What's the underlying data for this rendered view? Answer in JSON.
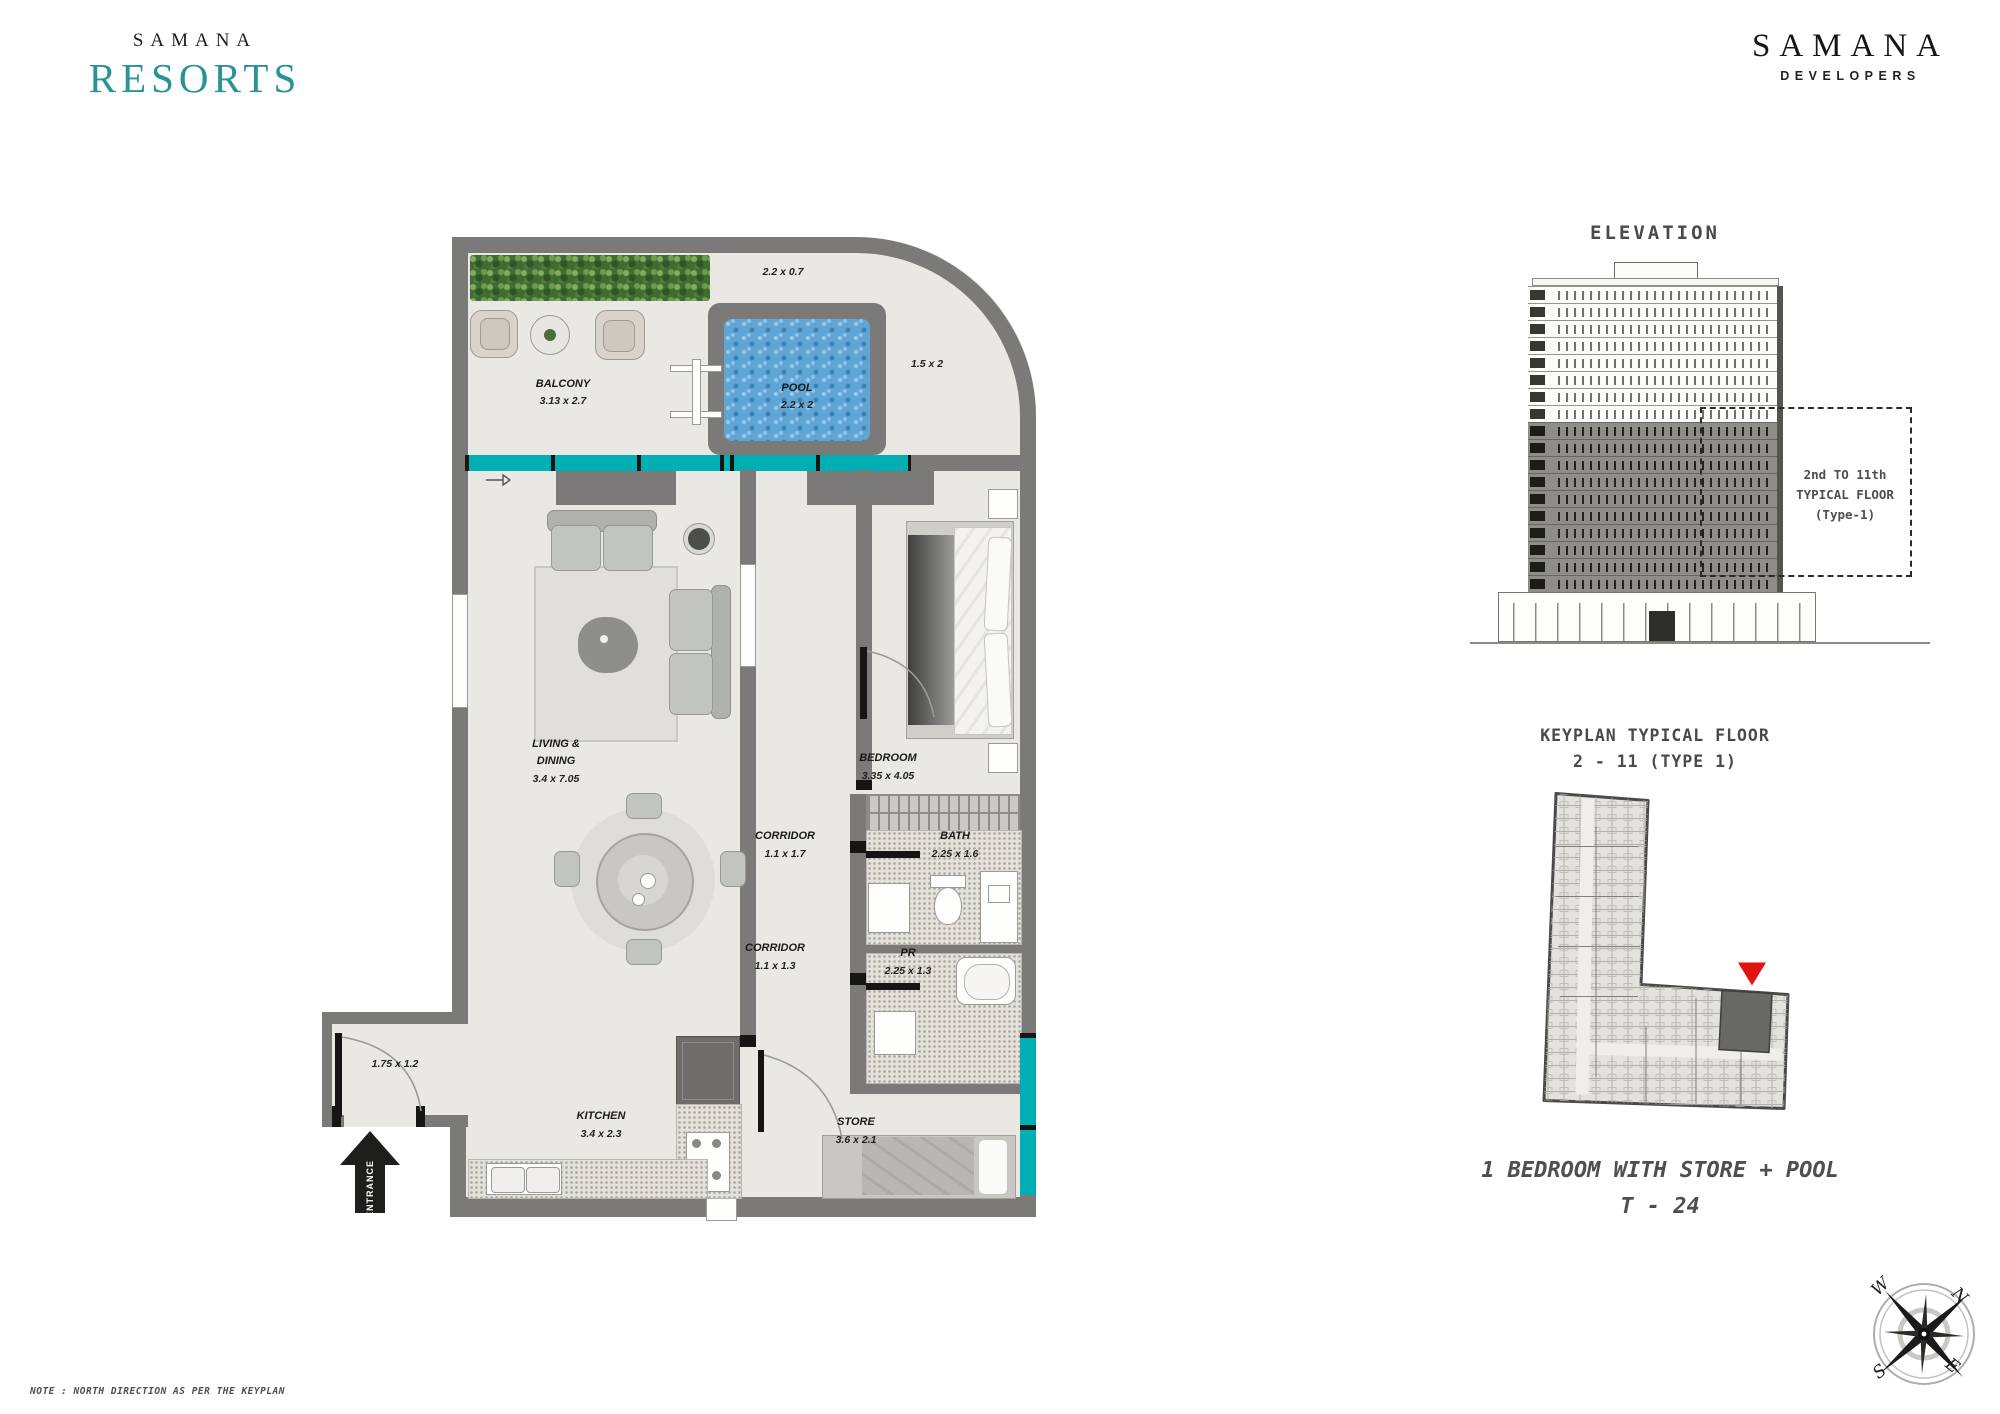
{
  "brand_left": {
    "name": "SAMANA",
    "sub": "RESORTS"
  },
  "brand_right": {
    "name": "SAMANA",
    "sub": "DEVELOPERS"
  },
  "plan": {
    "balcony_name": "BALCONY",
    "balcony_dims": "3.13 x 2.7",
    "pool_name": "POOL",
    "pool_dims": "2.2 x 2",
    "pool_deck_dims": "2.2 x 0.7",
    "side_deck_dims": "1.5 x 2",
    "living_name1": "LIVING &",
    "living_name2": "DINING",
    "living_dims": "3.4 x 7.05",
    "bedroom_name": "BEDROOM",
    "bedroom_dims": "3.35 x 4.05",
    "corridor1_name": "CORRIDOR",
    "corridor1_dims": "1.1 x 1.7",
    "bath_name": "BATH",
    "bath_dims": "2.25 x 1.6",
    "corridor2_name": "CORRIDOR",
    "corridor2_dims": "1.1 x 1.3",
    "pr_name": "PR",
    "pr_dims": "2.25 x 1.3",
    "entry_dims": "1.75 x 1.2",
    "kitchen_name": "KITCHEN",
    "kitchen_dims": "3.4 x 2.3",
    "store_name": "STORE",
    "store_dims": "3.6 x 2.1",
    "entrance_label": "ENTRANCE"
  },
  "elevation": {
    "title": "ELEVATION",
    "note1": "2nd TO 11th",
    "note2": "TYPICAL FLOOR",
    "note3": "(Type-1)"
  },
  "keyplan": {
    "title1": "KEYPLAN TYPICAL FLOOR",
    "title2": "2 - 11 (TYPE 1)"
  },
  "unit": {
    "name": "1 BEDROOM WITH STORE + POOL",
    "code": "T - 24"
  },
  "compass": {
    "n": "N",
    "e": "E",
    "s": "S",
    "w": "W"
  },
  "footnote": "NOTE : NORTH DIRECTION AS PER THE KEYPLAN",
  "colors": {
    "teal_window": "#00AFB4",
    "brand_teal": "#2B9398",
    "pool_blue": "#5FA5D6",
    "wall": "#7B7A78",
    "red_marker": "#E01212"
  }
}
